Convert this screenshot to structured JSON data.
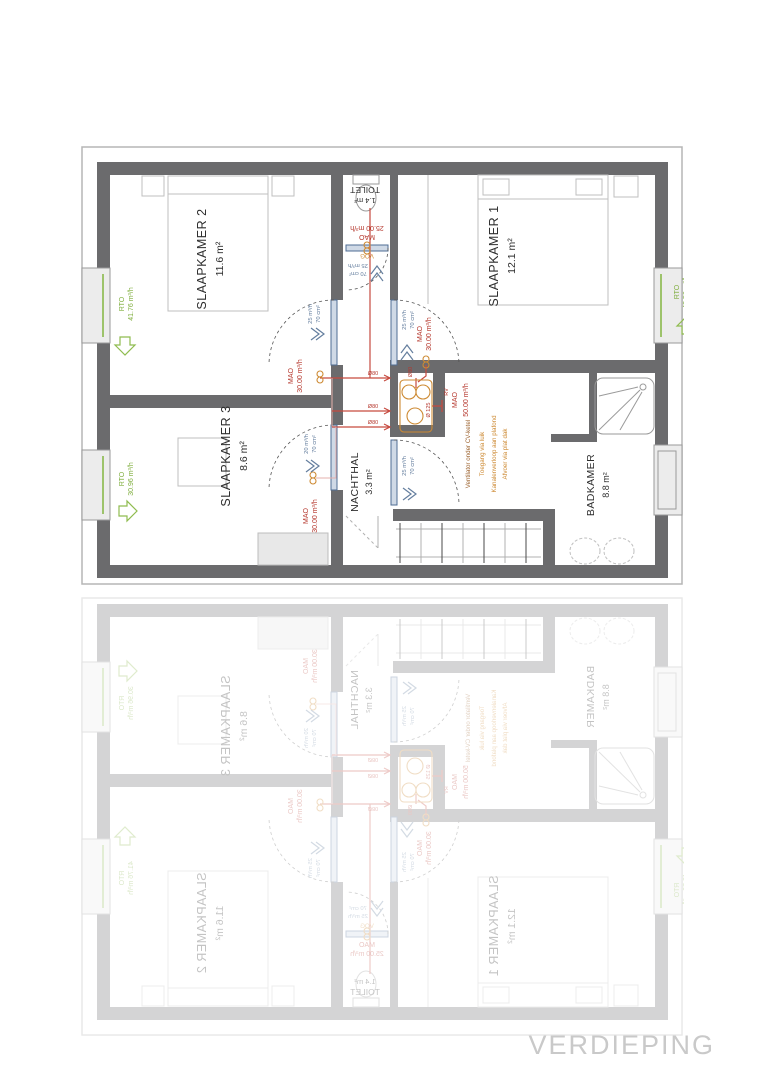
{
  "plan_title": "VERDIEPING",
  "colors": {
    "wall": "#6b6b6d",
    "rto_green": "#7fae3e",
    "mao_red": "#b5362c",
    "pipe_red": "#c64a3f",
    "orange": "#cd8a33",
    "note_brown": "#9a5f2a",
    "door_blue": "#647e9e",
    "caption_gray": "#c9c9c9"
  },
  "rooms": {
    "slaapkamer2": {
      "name": "SLAAPKAMER 2",
      "area": "11.6 m²"
    },
    "slaapkamer1": {
      "name": "SLAAPKAMER 1",
      "area": "12.1 m²"
    },
    "slaapkamer3": {
      "name": "SLAAPKAMER 3",
      "area": "8.6 m²"
    },
    "nachthal": {
      "name": "NACHTHAL",
      "area": "3.3 m²"
    },
    "toilet": {
      "name": "TOILET",
      "area": "1.4 m²"
    },
    "badkamer": {
      "name": "BADKAMER",
      "area": "8.8 m²"
    }
  },
  "ventilation": {
    "rto_slaapkamer2": {
      "code": "RTO",
      "value": "41.76 m³/h"
    },
    "rto_slaapkamer1": {
      "code": "RTO",
      "value": "43.56 m³/h"
    },
    "rto_slaapkamer3": {
      "code": "RTO",
      "value": "30.96 m³/h"
    },
    "mao_slaapkamer2": {
      "code": "MAO",
      "value": "30.00 m³/h"
    },
    "mao_slaapkamer1": {
      "code": "MAO",
      "value": "30.00 m³/h"
    },
    "mao_slaapkamer3": {
      "code": "MAO",
      "value": "30.00 m³/h"
    },
    "mao_toilet": {
      "code": "MAO",
      "value": "25.00 m³/h"
    },
    "mao_badkamer": {
      "code": "MAO",
      "value": "50.00 m³/h"
    },
    "door_slaapkamer2": {
      "flow": "25 m³/h",
      "section": "70 cm²"
    },
    "door_slaapkamer1": {
      "flow": "25 m³/h",
      "section": "70 cm²"
    },
    "door_slaapkamer3": {
      "flow": "20 m³/h",
      "section": "70 cm²"
    },
    "door_toilet": {
      "flow": "25 m³/h",
      "section": "70 cm²"
    },
    "door_badkamer": {
      "flow": "25 m³/h",
      "section": "70 cm²"
    },
    "vog_label": "VOG",
    "rv_label": "RV",
    "duct_80": "Ø80",
    "duct_125": "Ø 125"
  },
  "notes": {
    "line1": "Ventilator onder CV-ketel",
    "line2": "Toegang via luik",
    "line3": "Kanalenverloop aan plafond",
    "line4": "Afvoer via plat dak"
  }
}
